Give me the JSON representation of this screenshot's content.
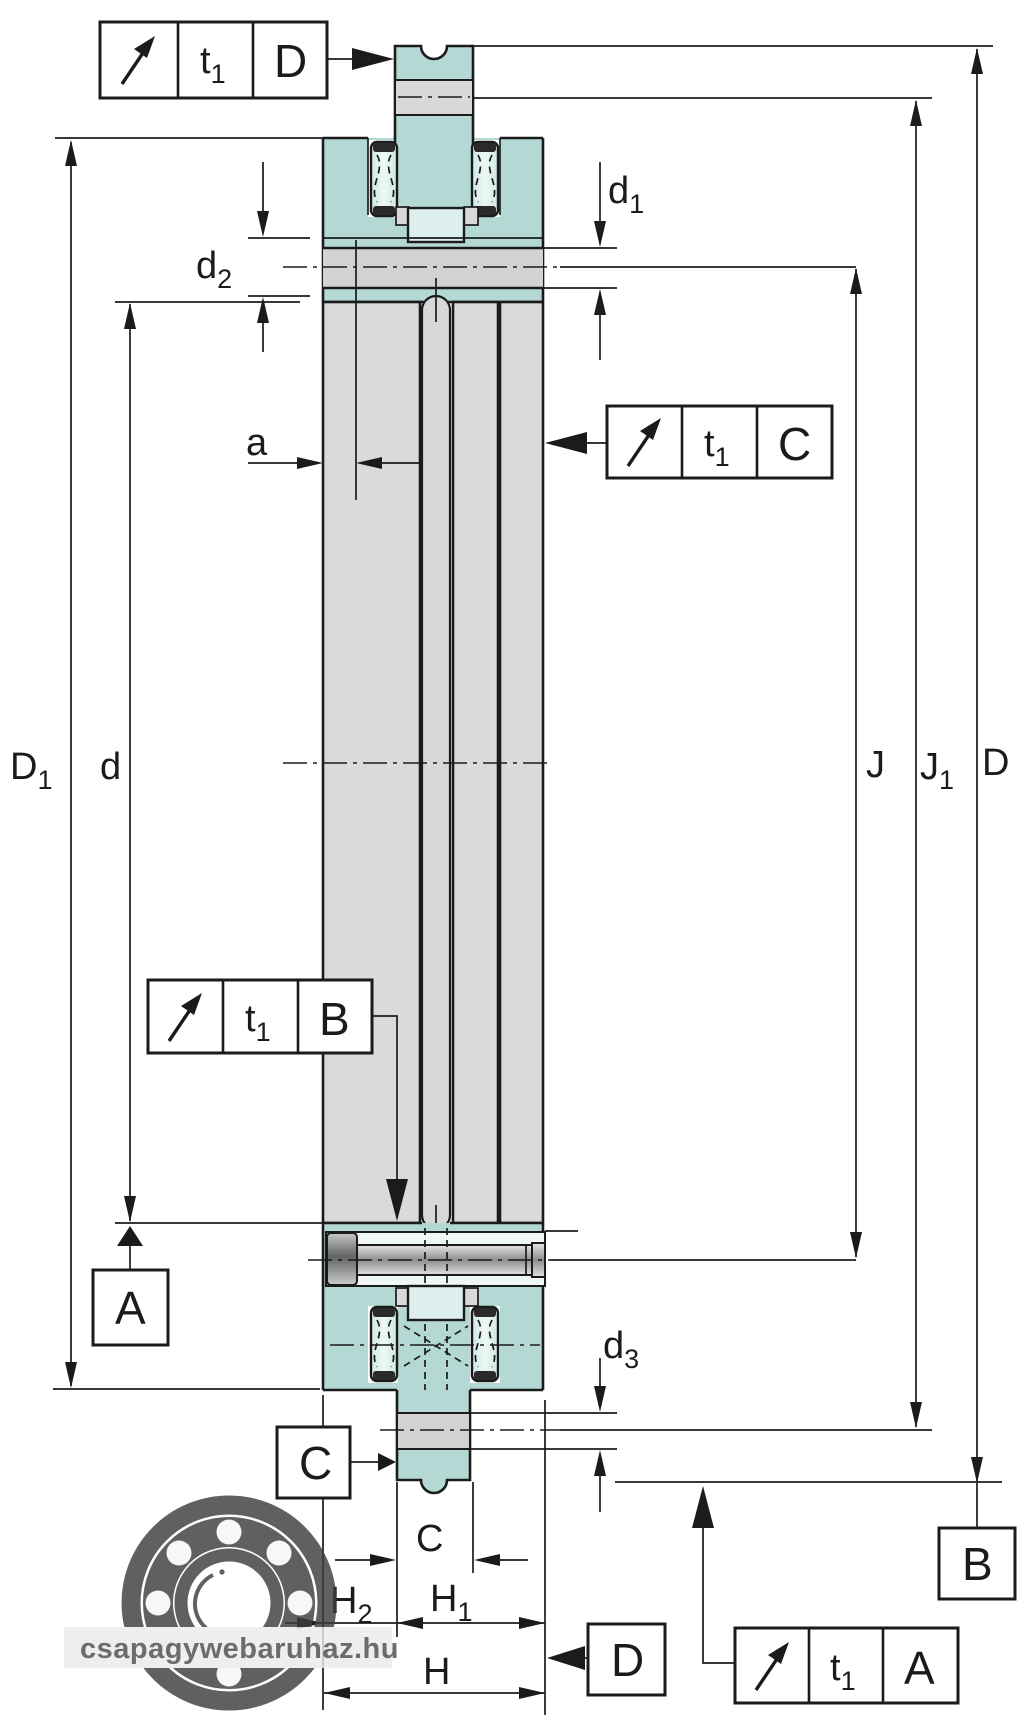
{
  "drawing": {
    "type": "axial-radial bearing cross-section technical drawing",
    "labels": {
      "D1": {
        "main": "D",
        "sub": "1"
      },
      "d": {
        "main": "d",
        "sub": ""
      },
      "d1": {
        "main": "d",
        "sub": "1"
      },
      "d2": {
        "main": "d",
        "sub": "2"
      },
      "d3": {
        "main": "d",
        "sub": "3"
      },
      "a": {
        "main": "a",
        "sub": ""
      },
      "J": {
        "main": "J",
        "sub": ""
      },
      "J1": {
        "main": "J",
        "sub": "1"
      },
      "D": {
        "main": "D",
        "sub": ""
      },
      "C": {
        "main": "C",
        "sub": ""
      },
      "H": {
        "main": "H",
        "sub": ""
      },
      "H1": {
        "main": "H",
        "sub": "1"
      },
      "H2": {
        "main": "H",
        "sub": "2"
      }
    },
    "callouts": [
      {
        "id": "top",
        "symbol": "runout-arrow",
        "tolerance": {
          "main": "t",
          "sub": "1"
        },
        "datum": "D"
      },
      {
        "id": "right",
        "symbol": "runout-arrow",
        "tolerance": {
          "main": "t",
          "sub": "1"
        },
        "datum": "C"
      },
      {
        "id": "left",
        "symbol": "runout-arrow",
        "tolerance": {
          "main": "t",
          "sub": "1"
        },
        "datum": "B"
      },
      {
        "id": "bottom",
        "symbol": "runout-arrow",
        "tolerance": {
          "main": "t",
          "sub": "1"
        },
        "datum": "A"
      }
    ],
    "datum_boxes": [
      {
        "id": "A",
        "letter": "A"
      },
      {
        "id": "B",
        "letter": "B"
      },
      {
        "id": "C",
        "letter": "C"
      },
      {
        "id": "D",
        "letter": "D"
      }
    ],
    "colors": {
      "teal": "#b4d9d4",
      "mint": "#dcefec",
      "grey": "#dadada",
      "band_grey": "#d2d2d2",
      "line": "#1b1b1b",
      "watermark_grey": "#3e3e3e"
    }
  },
  "watermark": {
    "text": "csapagywebaruhaz.hu"
  }
}
